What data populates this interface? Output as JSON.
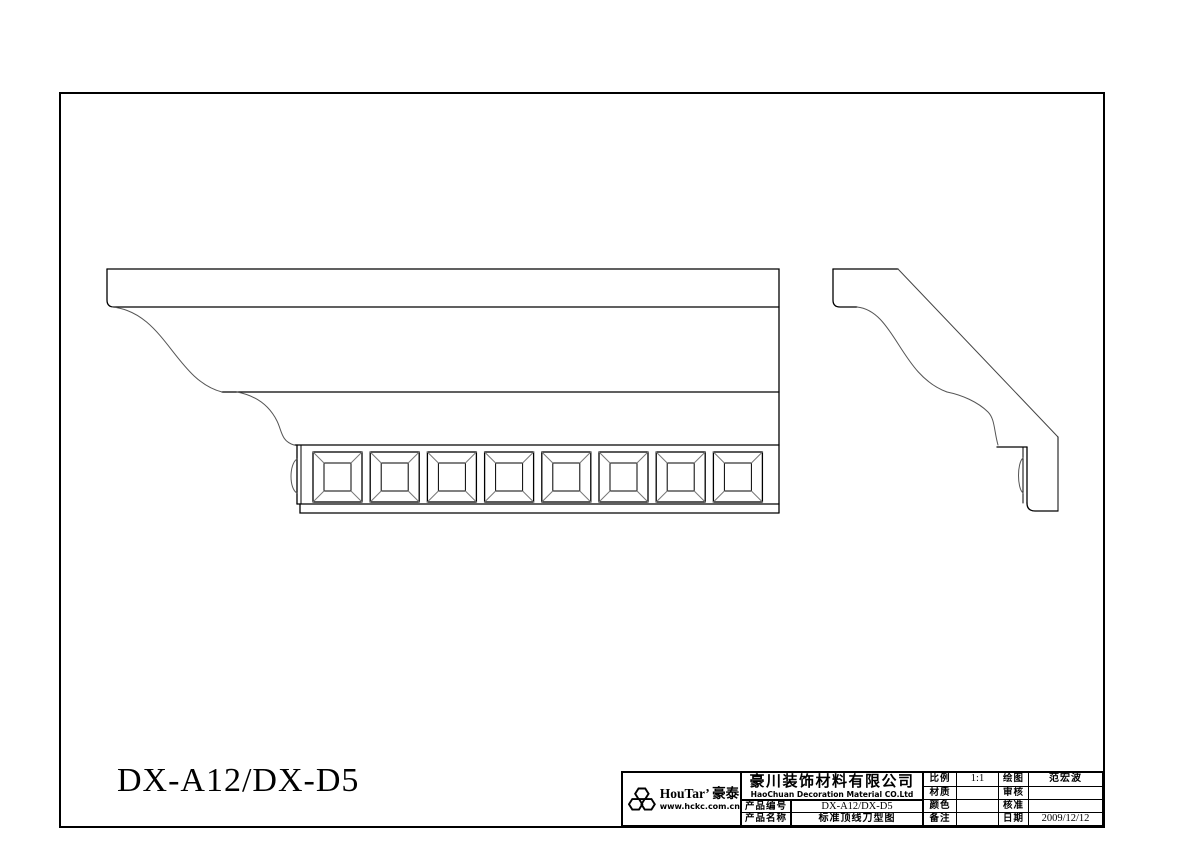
{
  "page": {
    "background_color": "#ffffff",
    "line_color": "#000000",
    "drawing_label": "DX-A12/DX-D5"
  },
  "drawing": {
    "dentil_count": 8,
    "views": [
      "front-elevation",
      "side-profile-section"
    ]
  },
  "title_block": {
    "logo": {
      "icon": "honeycomb-hexagons-icon",
      "brand": "HouTar’ 豪泰",
      "website": "www.hckc.com.cn"
    },
    "company": {
      "name_cn": "豪川装饰材料有限公司",
      "name_en": "HaoChuan Decoration Material CO.Ltd"
    },
    "fields": [
      {
        "label": "产品编号",
        "value": "DX-A12/DX-D5"
      },
      {
        "label": "产品名称",
        "value": "标准顶线刀型图"
      },
      {
        "label": "比例",
        "value": "1:1"
      },
      {
        "label": "材质",
        "value": ""
      },
      {
        "label": "颜色",
        "value": ""
      },
      {
        "label": "备注",
        "value": ""
      },
      {
        "label": "绘图",
        "value": "范宏波"
      },
      {
        "label": "审核",
        "value": ""
      },
      {
        "label": "核准",
        "value": ""
      },
      {
        "label": "日期",
        "value": "2009/12/12"
      }
    ]
  }
}
